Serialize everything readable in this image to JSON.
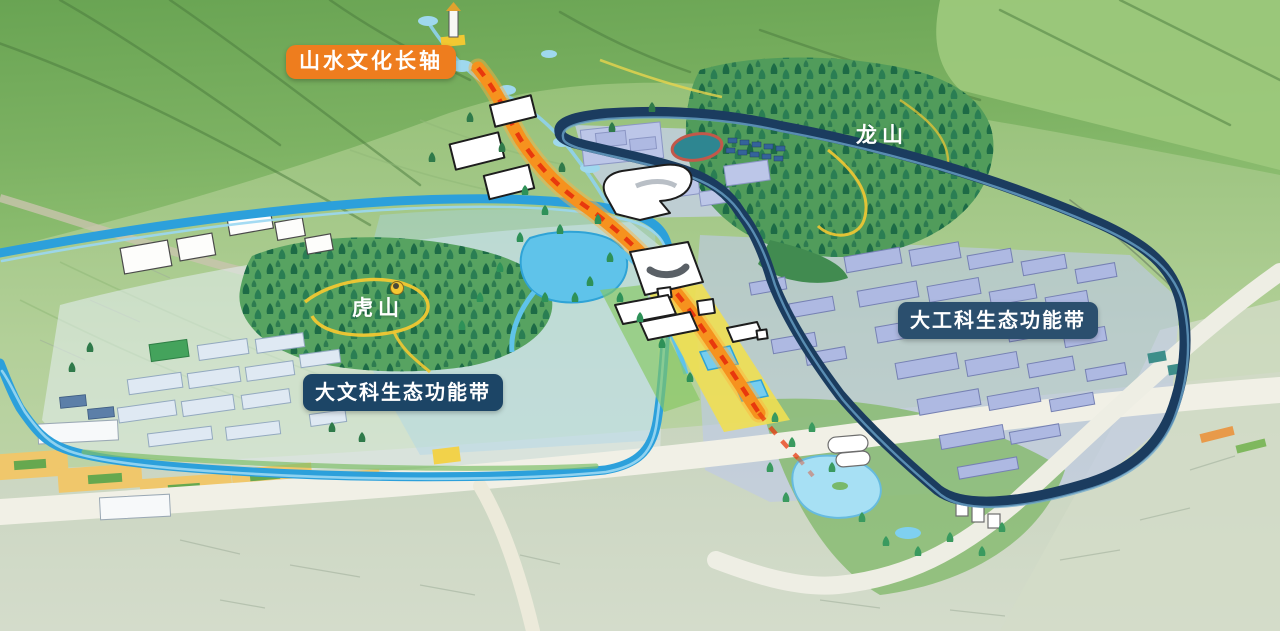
{
  "scene": {
    "type": "campus-masterplan-3d-map",
    "description": "Bird's-eye planning map with mountains, two campus belts and a central cultural axis"
  },
  "labels": {
    "axis_badge": "山水文化长轴",
    "longshan": "龙山",
    "hushan": "虎山",
    "engineering_belt_badge": "大工科生态功能带",
    "liberal_arts_belt_badge": "大文科生态功能带"
  },
  "colors": {
    "axis_badge_bg": "#ee7d1e",
    "engineering_belt_badge_bg": "#2b4f6e",
    "liberal_arts_belt_badge_bg": "#1c4566",
    "label_text": "#ffffff",
    "axis_road_orange": "#f6921e",
    "axis_centerline_red": "#e8380d",
    "liberal_arts_loop_blue": "#2ca0db",
    "engineering_loop_navy": "#1b3c5f",
    "trail_yellow": "#f2c832",
    "forest_green": "#1d6b46",
    "water_blue": "#5fc3ea",
    "landmark_building": "#ffffff",
    "engineering_building": "#aeb9e2",
    "residential_building": "#dfe9f3",
    "road_light": "#f1f0e6"
  }
}
